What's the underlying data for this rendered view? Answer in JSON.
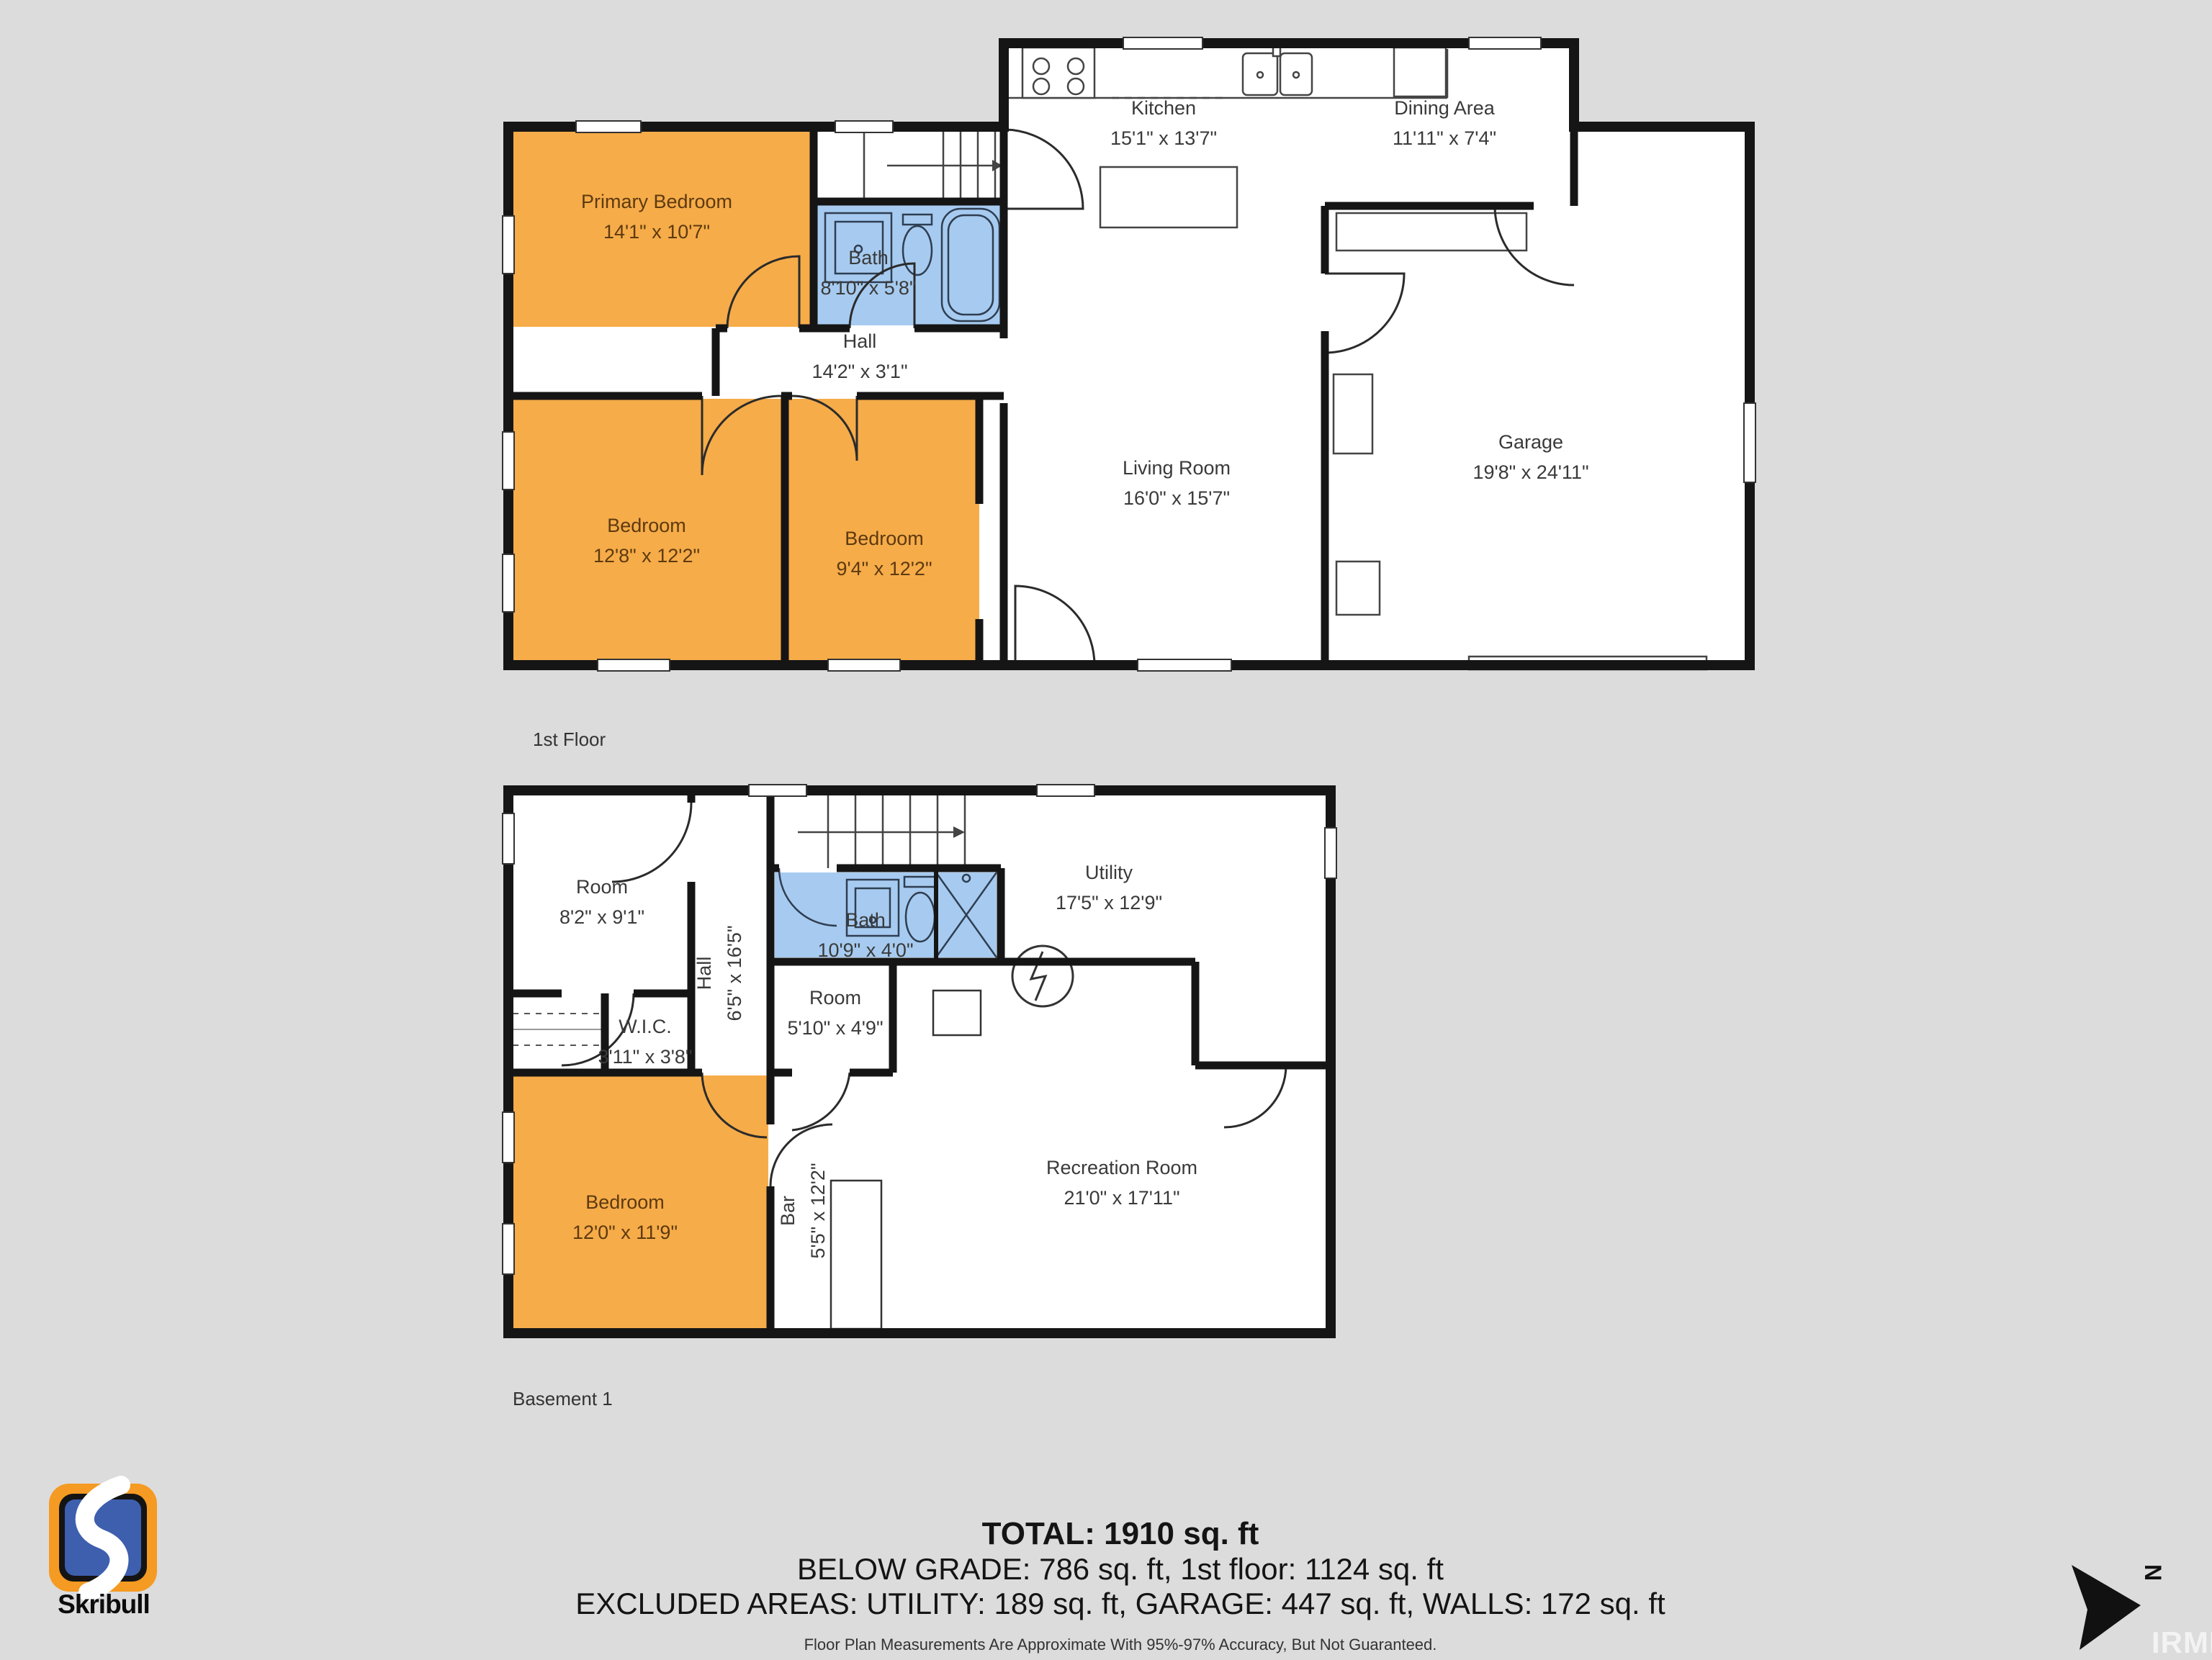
{
  "colors": {
    "background": "#dcdcdc",
    "bedroom_fill": "#F6AC49",
    "bath_fill": "#A7CBF0",
    "wall": "#151515",
    "logo_orange": "#F59A22",
    "logo_blue": "#3E5FAE"
  },
  "floor1": {
    "name": "1st Floor",
    "rooms": {
      "kitchen": {
        "label": "Kitchen",
        "dims": "15'1\" x 13'7\""
      },
      "dining": {
        "label": "Dining Area",
        "dims": "11'11\" x 7'4\""
      },
      "primary_bedroom": {
        "label": "Primary Bedroom",
        "dims": "14'1\" x 10'7\""
      },
      "bath": {
        "label": "Bath",
        "dims": "8'10\" x 5'8\""
      },
      "hall": {
        "label": "Hall",
        "dims": "14'2\" x 3'1\""
      },
      "bedroom_a": {
        "label": "Bedroom",
        "dims": "12'8\" x 12'2\""
      },
      "bedroom_b": {
        "label": "Bedroom",
        "dims": "9'4\" x 12'2\""
      },
      "living": {
        "label": "Living Room",
        "dims": "16'0\" x 15'7\""
      },
      "garage": {
        "label": "Garage",
        "dims": "19'8\" x 24'11\""
      }
    }
  },
  "basement": {
    "name": "Basement 1",
    "rooms": {
      "room_a": {
        "label": "Room",
        "dims": "8'2\" x 9'1\""
      },
      "hall": {
        "label": "Hall",
        "dims": "6'5\" x 16'5\""
      },
      "bath": {
        "label": "Bath",
        "dims": "10'9\" x 4'0\""
      },
      "utility": {
        "label": "Utility",
        "dims": "17'5\" x 12'9\""
      },
      "wic": {
        "label": "W.I.C.",
        "dims": "3'11\" x 3'8\""
      },
      "room_b": {
        "label": "Room",
        "dims": "5'10\" x 4'9\""
      },
      "bedroom": {
        "label": "Bedroom",
        "dims": "12'0\" x 11'9\""
      },
      "bar": {
        "label": "Bar",
        "dims": "5'5\" x 12'2\""
      },
      "recreation": {
        "label": "Recreation Room",
        "dims": "21'0\" x 17'11\""
      }
    }
  },
  "summary": {
    "total": "TOTAL: 1910 sq. ft",
    "below_grade_line": "BELOW GRADE: 786 sq. ft, 1st floor: 1124 sq. ft",
    "excluded_line": "EXCLUDED AREAS: UTILITY: 189 sq. ft, GARAGE: 447 sq. ft, WALLS: 172 sq. ft",
    "disclaimer": "Floor Plan Measurements Are Approximate With 95%-97% Accuracy, But Not Guaranteed."
  },
  "branding": {
    "logo_text": "Skribull"
  },
  "compass": {
    "label": "N"
  },
  "watermark": "IRMLS"
}
